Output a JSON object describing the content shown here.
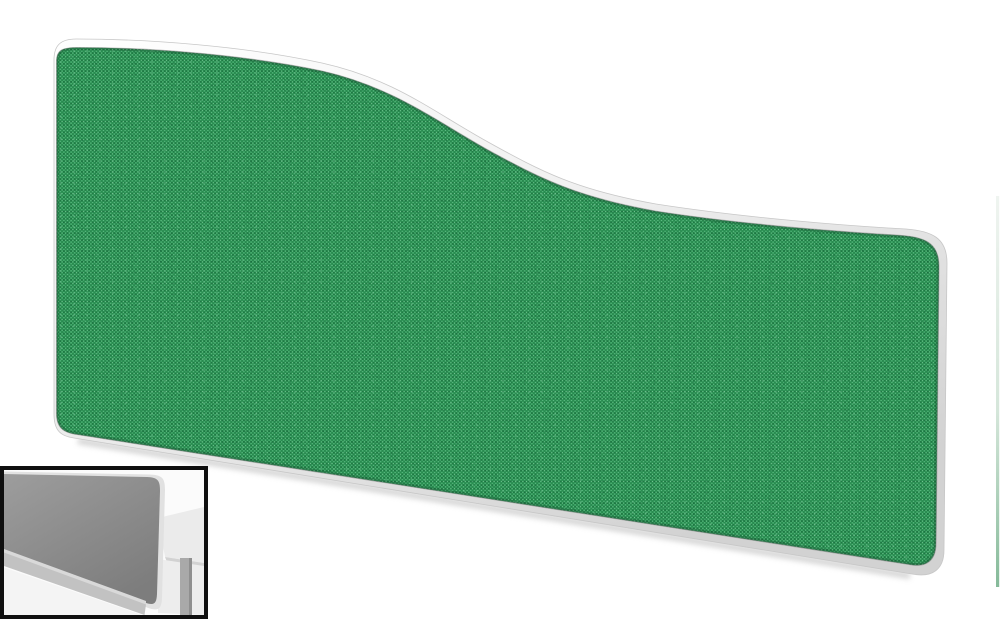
{
  "meta": {
    "description": "Product photograph of a wave-top office desk screen divider with green woven fabric and a white rounded frame; a grayscale in-situ thumbnail of the screen mounted on a desk sits in the bottom-left corner; a faint green sliver artifact runs along the right edge.",
    "background": "#ffffff"
  },
  "screen": {
    "frame": {
      "highlight": "#ffffff",
      "mid": "#f1f1f1",
      "shadow": "#d2d2d2",
      "stroke": "#c7c7c7"
    },
    "fabric": {
      "base": "#2f9b59",
      "weave_mid": "#28894f",
      "weave_dark": "#1e7843",
      "fleck_light": "#5fbd85",
      "fleck_lighter": "#7ecb9d",
      "fleck_dark": "#15603a",
      "edge_shade": "#174f30",
      "seam": "#6f6f6f"
    },
    "drop_shadow": "#a9a9a9"
  },
  "inset": {
    "border": "#0f0f0f",
    "background": "#fbfbfb",
    "desk_surface": "#ebebeb",
    "desk_edge": "#d2d2d2",
    "floor": "#ededed",
    "leg": "#a9a9a9",
    "leg_shade": "#8f8f8f",
    "panel_trim": "#e1e1e1",
    "panel_top": "#9d9d9d",
    "panel_bottom": "#7d7d7d",
    "rail_highlight": "#d9d9d9",
    "rail": "#c2c2c2",
    "foreground": "#f4f4f4"
  },
  "right_artifact": {
    "top": "#eff4f0",
    "mid": "#d5e6da",
    "bottom": "#85ba99"
  }
}
